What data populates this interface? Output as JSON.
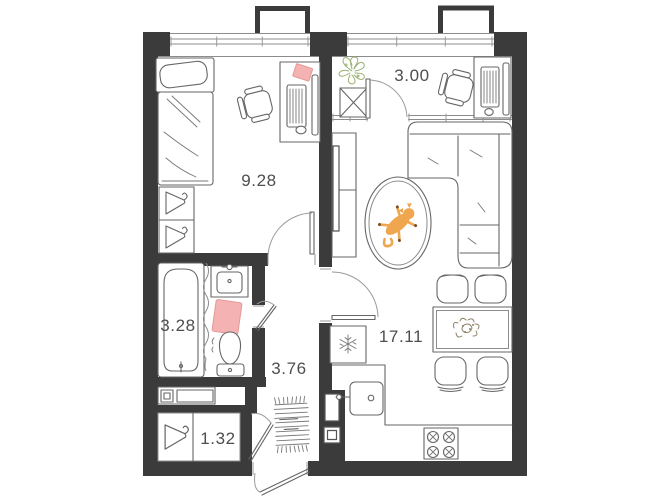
{
  "plan": {
    "type": "apartment-floor-plan",
    "colors": {
      "wall": "#3b3b3b",
      "furniture_line": "#666666",
      "window_line": "#8c8c8c",
      "label_text": "#4e4e4e",
      "accent_pink": "#f4b3b2",
      "cat_orange": "#efa64f",
      "plant_green": "#9ab174",
      "flower_olive": "#8d8266"
    },
    "rooms": {
      "bedroom": {
        "area": "9.28"
      },
      "loggia": {
        "area": "3.00"
      },
      "bathroom": {
        "area": "3.28"
      },
      "hallway": {
        "area": "3.76"
      },
      "kitchen_living": {
        "area": "17.11"
      },
      "wardrobe": {
        "area": "1.32"
      }
    },
    "icons": [
      "snowflake-icon",
      "hanger-icon",
      "stove-burner-icon",
      "plant-icon",
      "cat-icon",
      "flower-bouquet-icon",
      "bathtub-icon",
      "toilet-icon",
      "sink-icon",
      "bed-icon",
      "sofa-icon",
      "rug-icon",
      "doormat-icon"
    ]
  }
}
